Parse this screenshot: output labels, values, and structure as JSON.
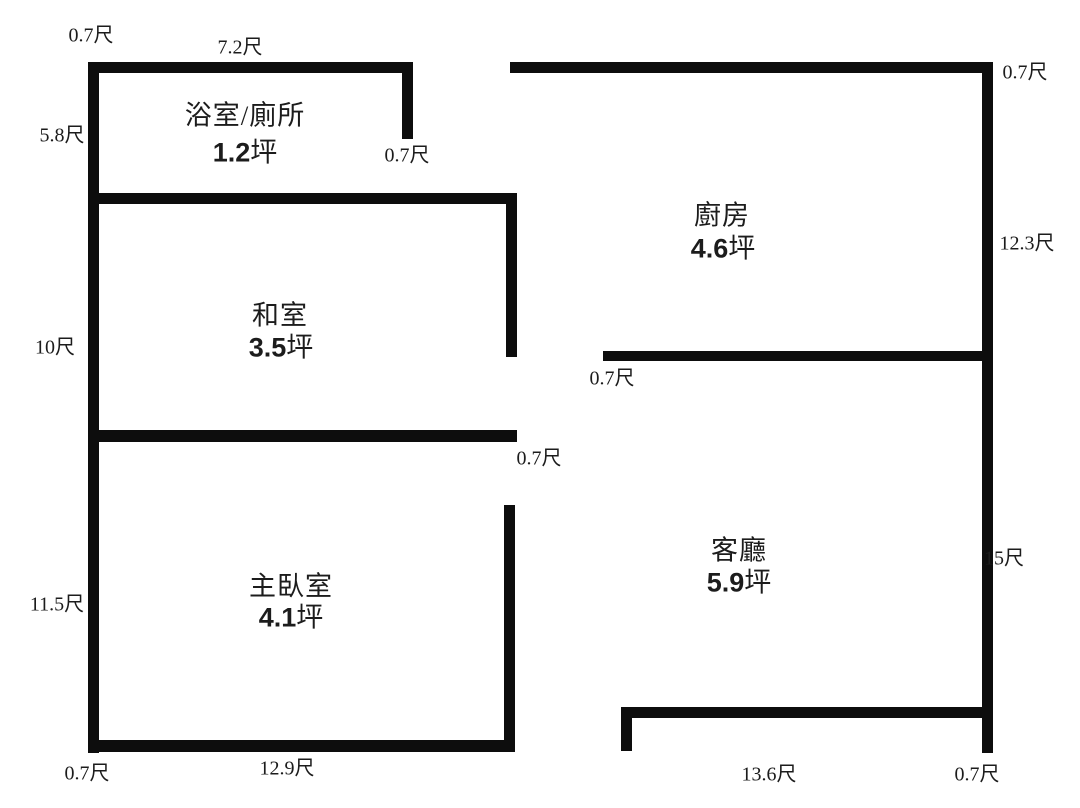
{
  "colors": {
    "wall": "#0d0d0d",
    "background": "#ffffff",
    "text": "#1c1c1c"
  },
  "rooms": [
    {
      "name": "浴室/廁所",
      "area_value": "1.2",
      "area_unit": "坪"
    },
    {
      "name": "和室",
      "area_value": "3.5",
      "area_unit": "坪"
    },
    {
      "name": "主臥室",
      "area_value": "4.1",
      "area_unit": "坪"
    },
    {
      "name": "廚房",
      "area_value": "4.6",
      "area_unit": "坪"
    },
    {
      "name": "客廳",
      "area_value": "5.9",
      "area_unit": "坪"
    }
  ],
  "dims": [
    "0.7尺",
    "7.2尺",
    "5.8尺",
    "0.7尺",
    "10尺",
    "0.7尺",
    "11.5尺",
    "0.7尺",
    "12.9尺",
    "0.7尺",
    "12.3尺",
    "0.7尺",
    "15尺",
    "13.6尺",
    "0.7尺"
  ]
}
